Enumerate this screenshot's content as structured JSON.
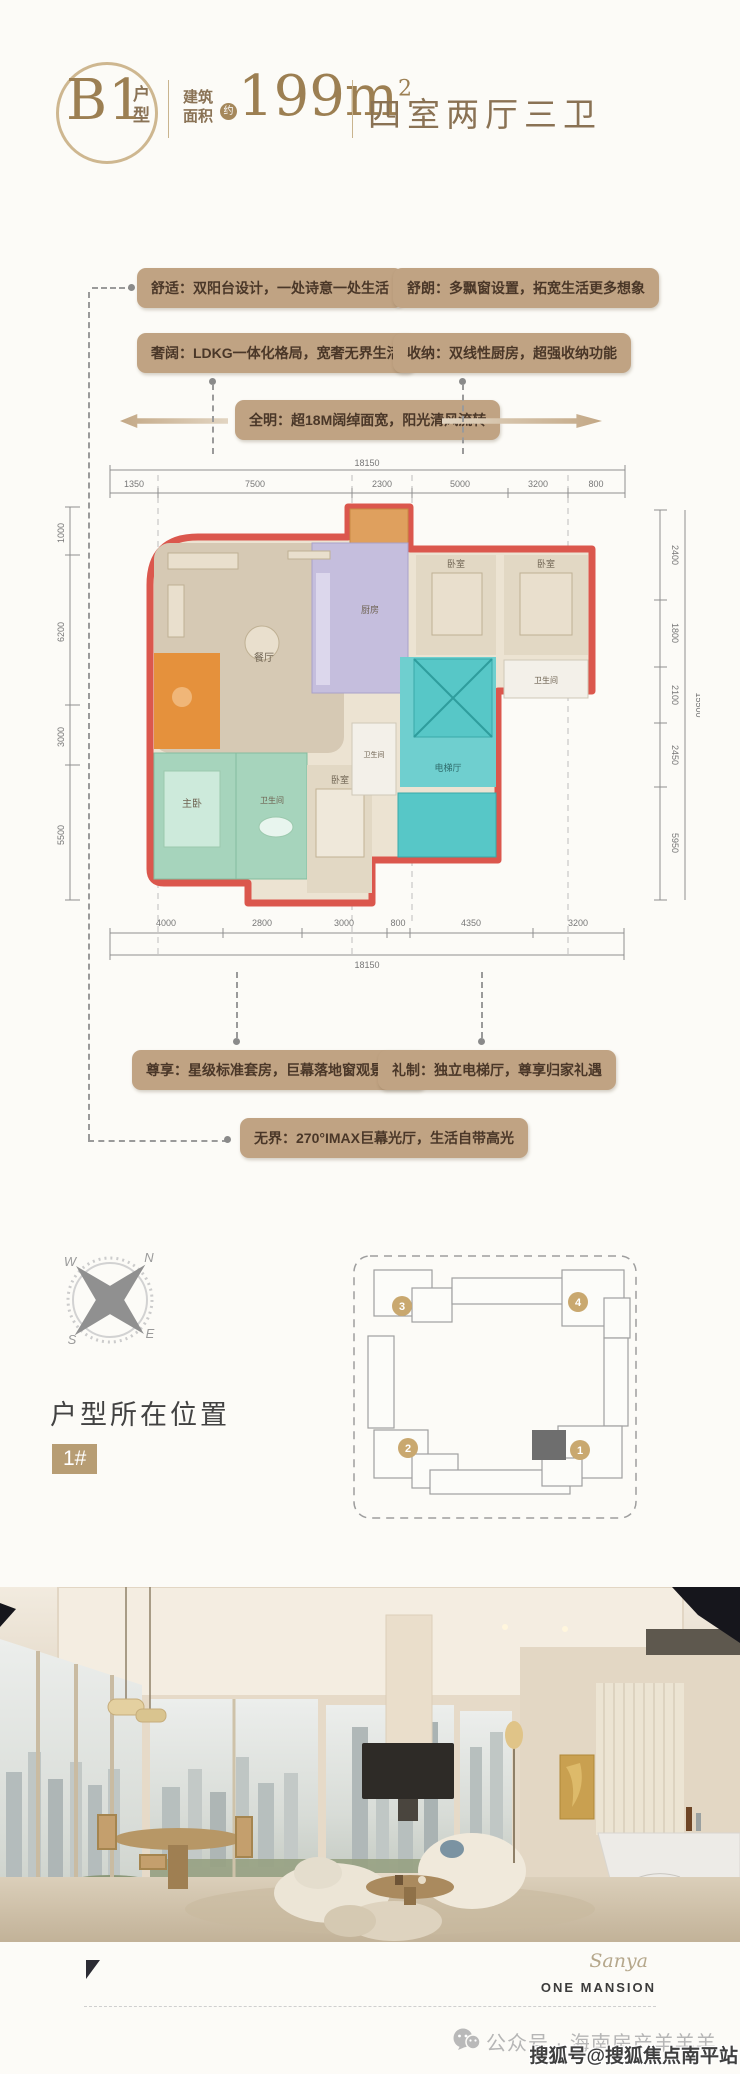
{
  "header": {
    "unit_code": "B1",
    "unit_suffix": "户型",
    "area_label_1": "建筑",
    "area_label_2": "面积",
    "area_approx": "约",
    "area_value": "199m",
    "area_sup": "2",
    "rooms_summary": "四室两厅三卫"
  },
  "tags": {
    "comfort": "舒适：双阳台设计，一处诗意一处生活",
    "bright": "舒朗：多飘窗设置，拓宽生活更多想象",
    "luxury": "奢阔：LDKG一体化格局，宽奢无界生活",
    "storage": "收纳：双线性厨房，超强收纳功能",
    "daylight": "全明：超18M阔绰面宽，阳光清风流转",
    "suite": "尊享：星级标准套房，巨幕落地窗观景视野",
    "ritual": "礼制：独立电梯厅，尊享归家礼遇",
    "boundless": "无界：270°IMAX巨幕光厅，生活自带高光"
  },
  "floorplan": {
    "dims_top": [
      "1350",
      "7500",
      "2300",
      "5000",
      "3200",
      "800"
    ],
    "dims_top_total": "18150",
    "dims_bottom": [
      "4000",
      "2800",
      "3000",
      "800",
      "4350",
      "3200"
    ],
    "dims_bottom_total": "18150",
    "dims_left": [
      "1000",
      "6200",
      "3000",
      "5500"
    ],
    "dims_right": [
      "2400",
      "1800",
      "2100",
      "2450",
      "5950"
    ],
    "dims_right_total": "15500",
    "rooms": {
      "dining": "餐厅",
      "kitchen": "厨房",
      "bedroom_a": "卧室",
      "bedroom_b": "卧室",
      "bath_a": "卫生间",
      "bath_b": "卫生间",
      "bath_c": "卫生间",
      "master": "主卧",
      "bedroom_c": "卧室",
      "elevator_hall": "电梯厅"
    }
  },
  "location": {
    "heading": "户型所在位置",
    "badge": "1#",
    "compass": {
      "n": "N",
      "e": "E",
      "s": "S",
      "w": "W"
    },
    "buildings": [
      "1",
      "2",
      "3",
      "4"
    ]
  },
  "footer": {
    "brand_script": "Sanya",
    "brand_name": "ONE MANSION",
    "account": "公众号 · 海南房产羊羊羊",
    "watermark": "搜狐号@搜狐焦点南平站"
  }
}
